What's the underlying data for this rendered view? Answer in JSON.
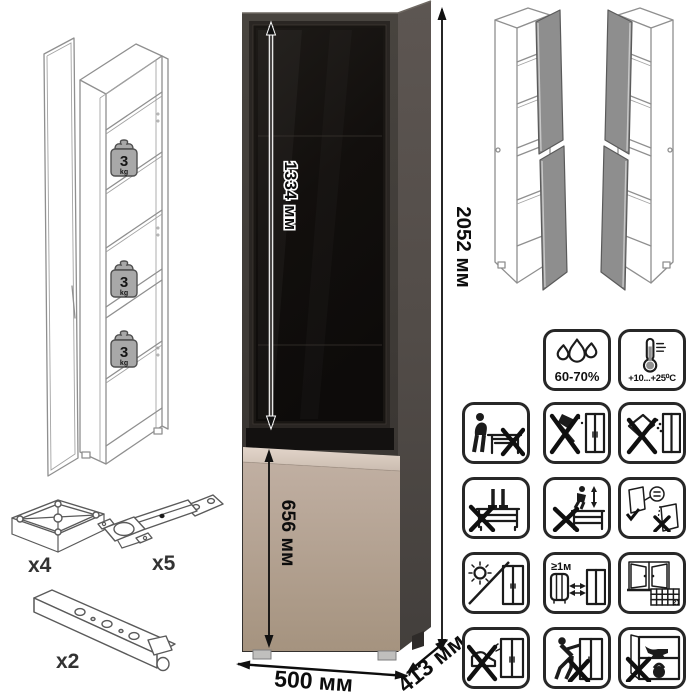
{
  "product": {
    "name": "display-cabinet",
    "colors": {
      "frame": "#403c39",
      "side_panel": "#544e4a",
      "glass": "#141110",
      "door_body": "#b4a295",
      "door_top_strip": "#dccec3",
      "wireframe_line": "#8f8f8f"
    }
  },
  "dimensions": {
    "total_height": "2052 мм",
    "glass_door_height": "1334 мм",
    "lower_door_height": "656 мм",
    "width": "500 мм",
    "depth": "413 мм"
  },
  "shelf_load": {
    "value": "3",
    "unit": "kg"
  },
  "hardware": {
    "foot_glide_count": "x4",
    "hinge_count": "x5",
    "rail_count": "x2"
  },
  "climate": {
    "humidity": "60-70%",
    "temperature": "+10...+25⁰C"
  },
  "warnings": {
    "radiator_distance": "≥1м",
    "acclimatize_days": "21"
  }
}
